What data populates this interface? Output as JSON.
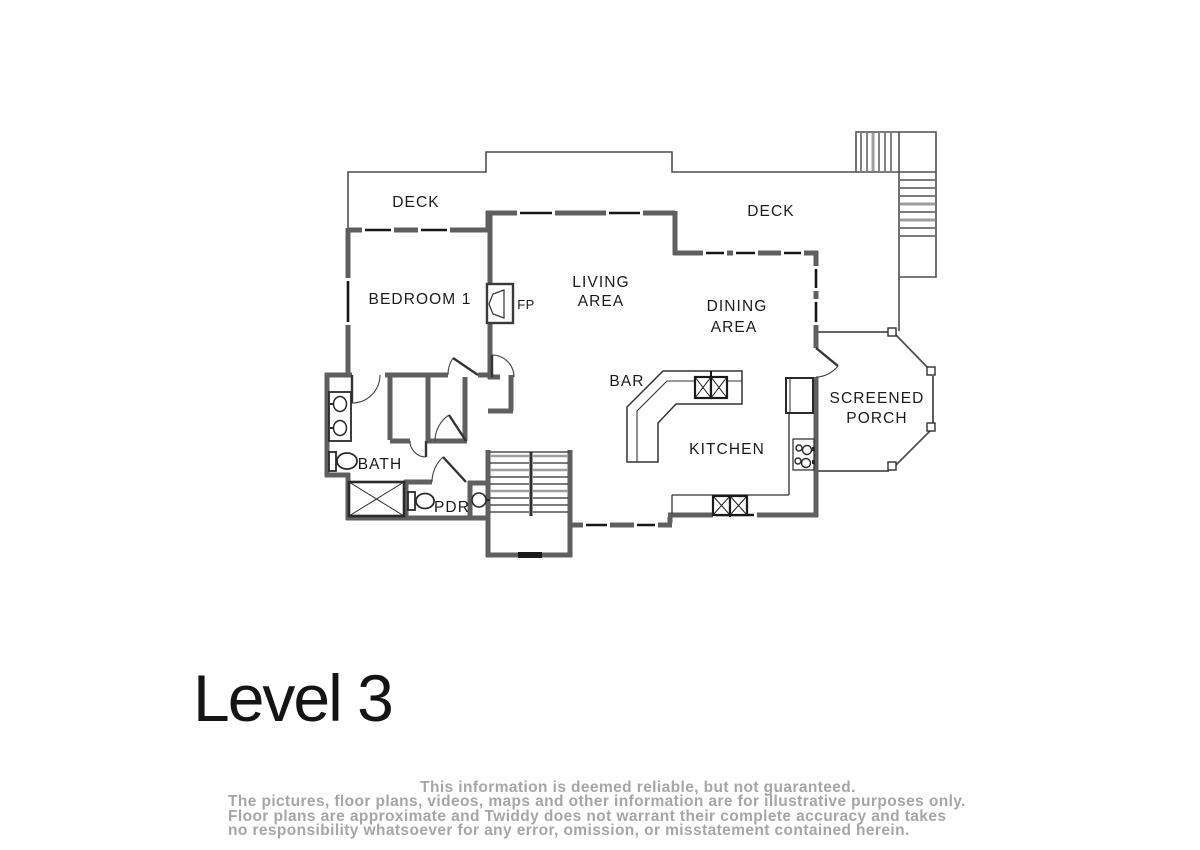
{
  "title": {
    "text": "Level 3"
  },
  "plan": {
    "rooms": {
      "deck_left": "DECK",
      "deck_right": "DECK",
      "bedroom_1": "BEDROOM 1",
      "living_line1": "LIVING",
      "living_line2": "AREA",
      "dining_line1": "DINING",
      "dining_line2": "AREA",
      "bar": "BAR",
      "kitchen": "KITCHEN",
      "porch_line1": "SCREENED",
      "porch_line2": "PORCH",
      "bath": "BATH",
      "pdr": "PDR",
      "fireplace": "FP"
    },
    "symbols": [
      "fireplace-icon",
      "bar-sink-icon",
      "kitchen-sink-icon",
      "range-burners-icon",
      "refrigerator-icon",
      "vanity-double-sink-icon",
      "toilet-icon",
      "shower-icon",
      "powder-sink-icon",
      "interior-stairs-icon",
      "exterior-stairs-icon",
      "screened-porch-post-icon",
      "door-swing-icon",
      "window-icon"
    ]
  },
  "colors": {
    "wall_gray": "#5f5f5f",
    "window_black": "#161616",
    "thin_line": "#4f4f4f",
    "tread_gray": "#9e9e9e",
    "label_text": "#1b1b1b",
    "disclaimer_text": "#a6a6a6",
    "background": "#ffffff"
  },
  "footer": {
    "line1": "This information is deemed reliable, but not guaranteed.",
    "line2": "The pictures, floor plans, videos, maps and other information are for illustrative purposes only.",
    "line3": "Floor plans are approximate and Twiddy does not warrant their complete accuracy and takes",
    "line4": "no responsibility whatsoever for any error, omission, or misstatement contained herein."
  }
}
